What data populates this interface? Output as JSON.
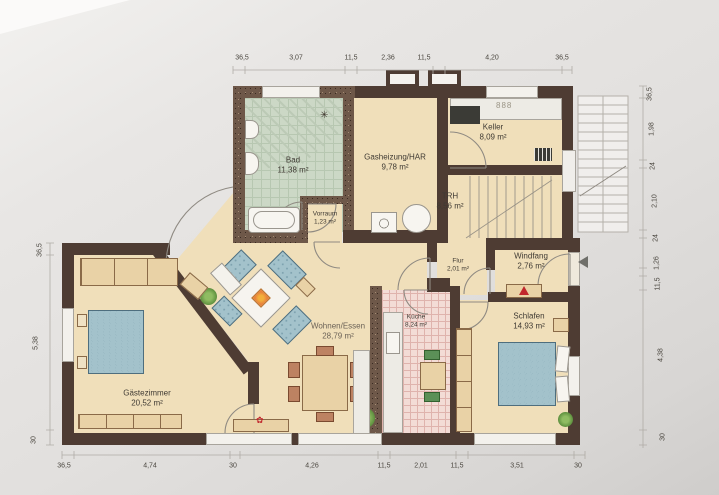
{
  "title": "Grundriss",
  "rooms": [
    {
      "name": "Bad",
      "area": "11,38 m²"
    },
    {
      "name": "Gasheizung/HAR",
      "area": "9,78 m²"
    },
    {
      "name": "Keller",
      "area": "8,09 m²"
    },
    {
      "name": "TRH",
      "area": "8,56 m²"
    },
    {
      "name": "Vorraum",
      "area": "1,23 m²"
    },
    {
      "name": "Flur",
      "area": "2,01 m²"
    },
    {
      "name": "Windfang",
      "area": "2,76 m²"
    },
    {
      "name": "Wohnen/Essen",
      "area": "28,79 m²"
    },
    {
      "name": "Küche",
      "area": "8,24 m²"
    },
    {
      "name": "Schlafen",
      "area": "14,93 m²"
    },
    {
      "name": "Gästezimmer",
      "area": "20,52 m²"
    }
  ],
  "dimensions": {
    "top": [
      "36,5",
      "3,07",
      "11,5",
      "2,36",
      "11,5",
      "4,20",
      "36,5"
    ],
    "bottom": [
      "36,5",
      "4,74",
      "30",
      "4,26",
      "11,5",
      "2,01",
      "11,5",
      "3,51",
      "30"
    ],
    "left": [
      "36,5",
      "5,38",
      "30"
    ],
    "right": [
      "36,5",
      "1,98",
      "24",
      "2,10",
      "24",
      "1,26",
      "11,5",
      "4,38",
      "30"
    ]
  },
  "icons": {
    "stove_burners": "888",
    "flower": "✿",
    "fan": "✳"
  },
  "colors": {
    "wall": "#4e3c33",
    "floor": "#f0dfba",
    "bath_tile": "#ccd8c6",
    "kitchen_tile": "#f3dcd6",
    "sofa_blue": "#a3c2cb",
    "furniture_tan": "#e9d2a6",
    "accent_red": "#c1272d"
  }
}
